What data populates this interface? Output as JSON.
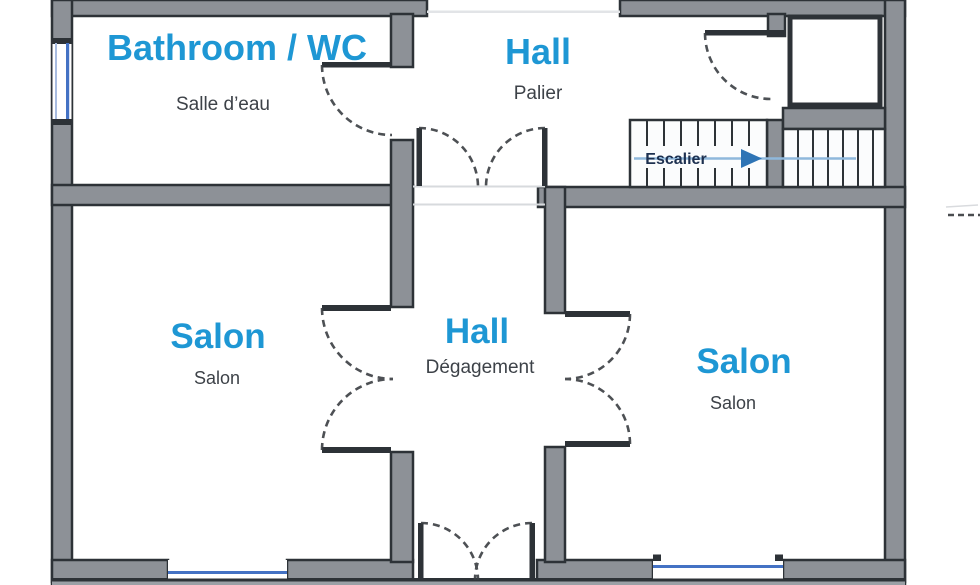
{
  "plan": {
    "rooms": {
      "bathroom": {
        "title": "Bathroom / WC",
        "subtitle": "Salle d’eau"
      },
      "hall_upper": {
        "title": "Hall",
        "subtitle": "Palier"
      },
      "salon_left": {
        "title": "Salon",
        "subtitle": "Salon"
      },
      "hall_center": {
        "title": "Hall",
        "subtitle": "Dégagement"
      },
      "salon_right": {
        "title": "Salon",
        "subtitle": "Salon"
      }
    },
    "stairs": {
      "label": "Escalier",
      "direction_icon": "right-arrow"
    },
    "colors": {
      "room_title": "#1e97d4",
      "room_subtitle": "#3d4248",
      "wall_fill": "#8d9197",
      "wall_stroke": "#2d3237",
      "window_blue": "#4472c4",
      "stairs_label": "#1d3050",
      "stairs_arrow": "#2e74b5",
      "stairs_line": "#8fb8dc"
    }
  }
}
